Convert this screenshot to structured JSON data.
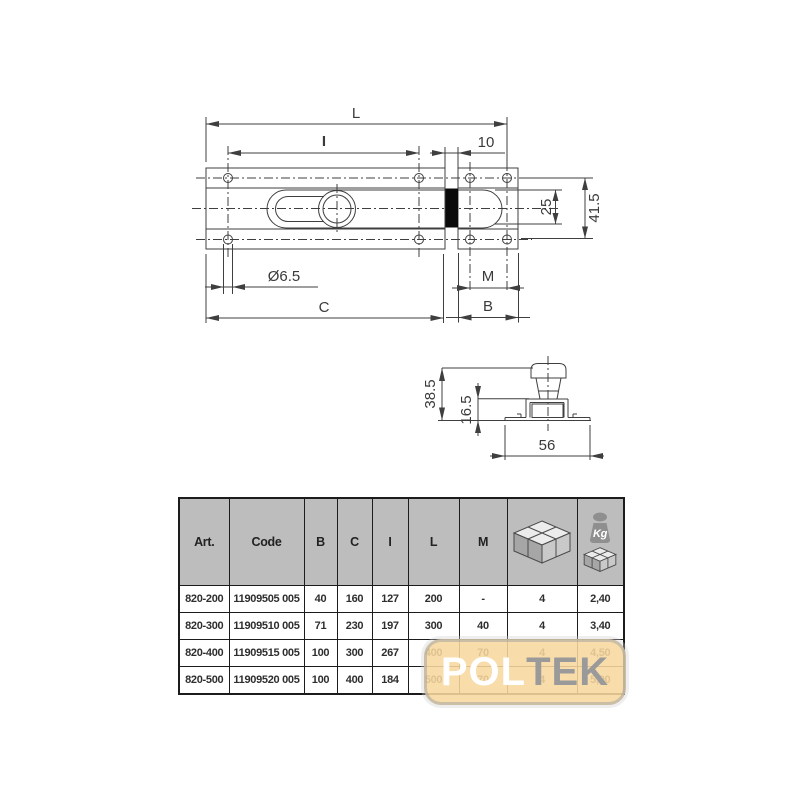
{
  "drawing": {
    "top": {
      "L": "L",
      "I": "I",
      "ten": "10",
      "twentyfive": "25",
      "fortyone": "41.5",
      "dia": "Ø6.5",
      "C": "C",
      "M": "M",
      "B": "B"
    },
    "side": {
      "total_h": "38.5",
      "base_h": "16.5",
      "width": "56"
    }
  },
  "table": {
    "headers": [
      "Art.",
      "Code",
      "B",
      "C",
      "I",
      "L",
      "M"
    ],
    "kg_label": "Kg",
    "icons": [
      "package-icon",
      "kg-weight-icon"
    ],
    "rows": [
      [
        "820-200",
        "11909505 005",
        "40",
        "160",
        "127",
        "200",
        "-",
        "4",
        "2,40"
      ],
      [
        "820-300",
        "11909510 005",
        "71",
        "230",
        "197",
        "300",
        "40",
        "4",
        "3,40"
      ],
      [
        "820-400",
        "11909515 005",
        "100",
        "300",
        "267",
        "400",
        "70",
        "4",
        "4,50"
      ],
      [
        "820-500",
        "11909520 005",
        "100",
        "400",
        "184",
        "500",
        "70",
        "4",
        "5,90"
      ]
    ]
  },
  "watermark": {
    "pol": "POL",
    "tek": "TEK"
  },
  "colors": {
    "header_bg": "#bdbdbd",
    "line": "#3f3f3f",
    "watermark_bg": "#f7d79e",
    "watermark_pol": "#ffffff",
    "watermark_tek": "#9a9a9a"
  }
}
